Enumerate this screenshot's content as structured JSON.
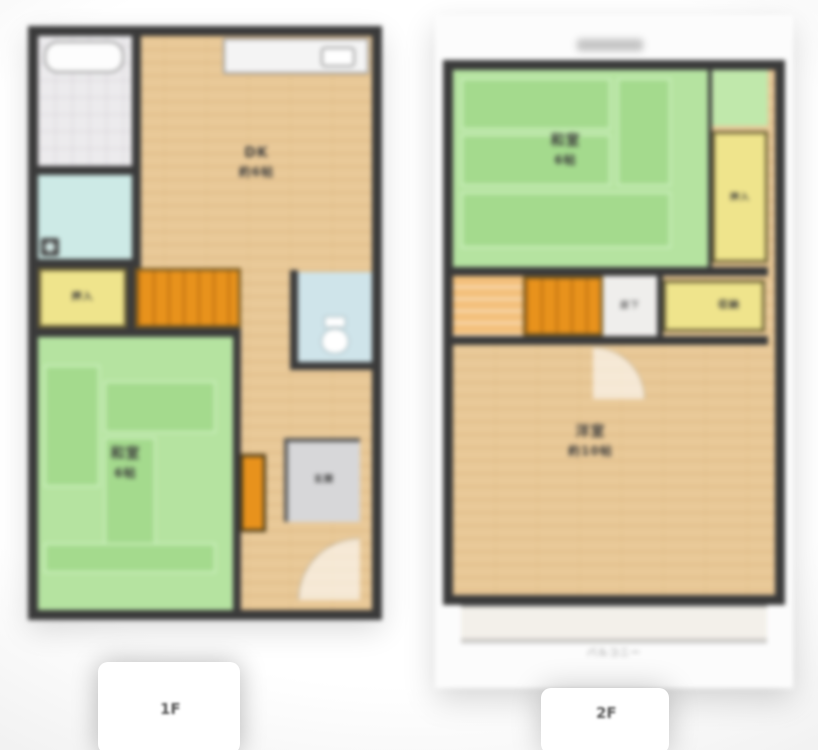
{
  "floors": [
    {
      "label": "1F",
      "rooms": {
        "dk": {
          "name": "DK",
          "size": "約6帖"
        },
        "washitsu": {
          "name": "和室",
          "size": "6帖"
        },
        "oshiire": "押入",
        "genkan": "玄関"
      }
    },
    {
      "label": "2F",
      "rooms": {
        "washitsu": {
          "name": "和室",
          "size": "6帖"
        },
        "oshiire": "押入",
        "shuno": "収納",
        "hall": "廊下",
        "yoshitsu": {
          "name": "洋室",
          "size": "約10帖"
        },
        "balcony": "バルコニー"
      }
    }
  ],
  "colors": {
    "wall": "#3a3a3a",
    "wood": "#e9c998",
    "tatami": "#b5e3a0",
    "tatami_dark": "#a4da8d",
    "closet": "#efe48c",
    "stairs": "#e8921c",
    "stairs_light": "#f3c07c",
    "wet": "#cdeae6",
    "toilet_room": "#cfe4ea",
    "tile": "#ecebed",
    "entrance_gray": "#d7d7d9",
    "text": "#3c3c3c",
    "floor_label": "#555555"
  }
}
